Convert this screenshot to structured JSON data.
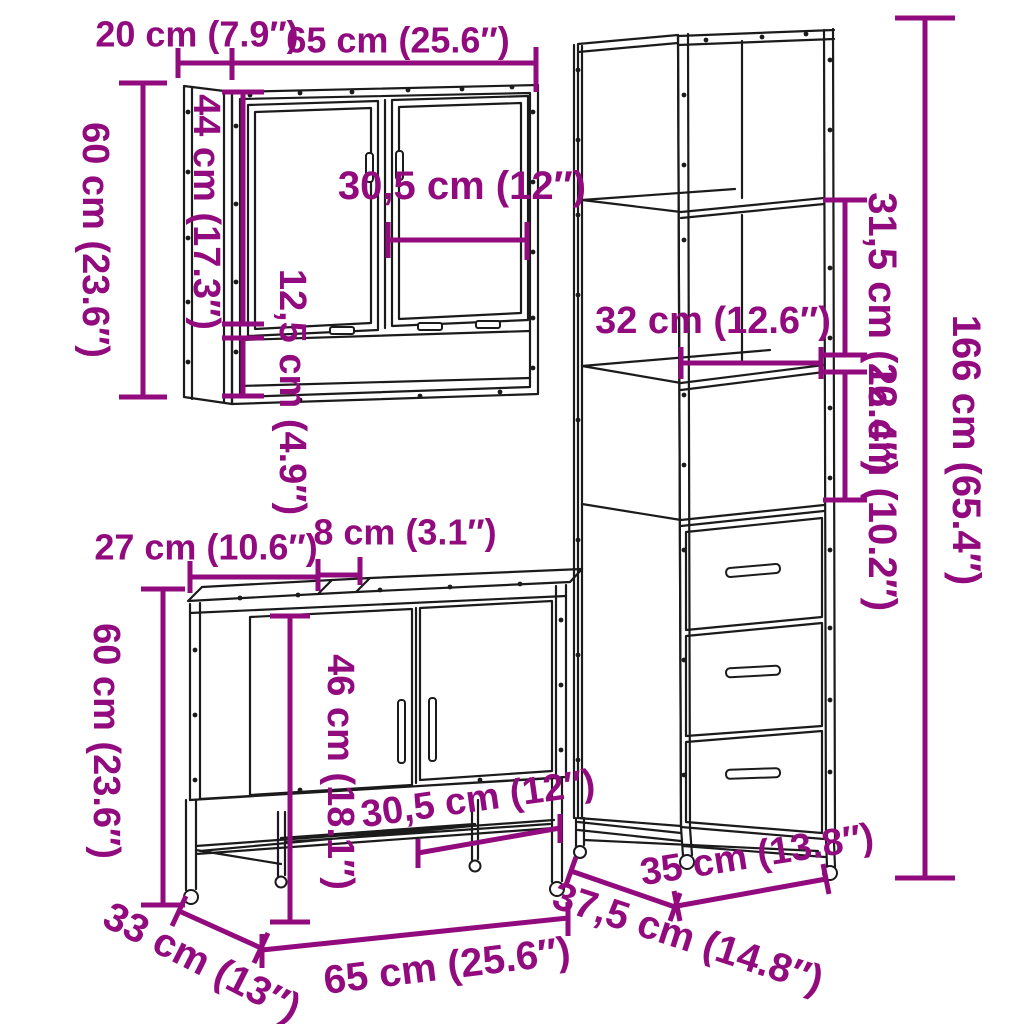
{
  "diagram": {
    "colors": {
      "accent": "#920b7e",
      "line_art": "#1b1b1b",
      "background": "#ffffff"
    },
    "mirror_cabinet": {
      "depth_label": "20 cm (7.9″)",
      "width_label": "65 cm (25.6″)",
      "height_label": "60 cm (23.6″)",
      "inner_height_label": "44 cm (17.3″)",
      "door_width_label": "30,5 cm (12″)",
      "shelf_height_label": "12,5 cm (4.9″)"
    },
    "tall_cabinet": {
      "upper_section_label": "31,5 cm (12.4″)",
      "shelf_width_label": "32 cm (12.6″)",
      "middle_section_label": "26 cm (10.2″)",
      "height_label": "166 cm (65.4″)",
      "width_label": "35 cm (13.8″)",
      "depth_label": "37,5 cm (14.8″)"
    },
    "vanity_cabinet": {
      "top_left_width_label": "27 cm (10.6″)",
      "gap_width_label": "8 cm (3.1″)",
      "height_label": "60 cm (23.6″)",
      "inner_height_label": "46 cm (18.1″)",
      "door_width_label": "30,5 cm (12″)",
      "width_label": "65 cm (25.6″)",
      "depth_label": "33 cm (13″)"
    }
  }
}
